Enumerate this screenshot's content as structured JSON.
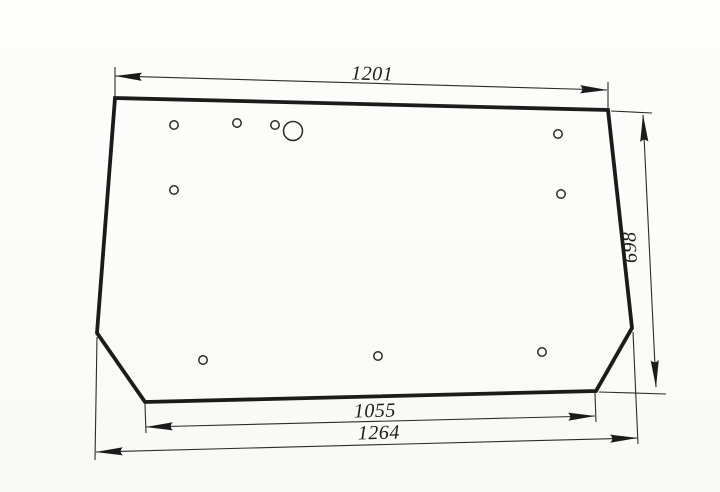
{
  "drawing": {
    "kind": "engineering-dimension-drawing",
    "subject": "trapezoidal glass panel with clipped bottom corners and mounting holes",
    "dimensions": {
      "top_width": "1201",
      "side_height": "698",
      "bottom_inner_width": "1055",
      "bottom_overall_width": "1264"
    },
    "holes": {
      "small_hole_count": 9,
      "large_hole_count": 1
    },
    "colors": {
      "paper": "#fcfcf9",
      "ink": "#1b1b1b"
    }
  }
}
